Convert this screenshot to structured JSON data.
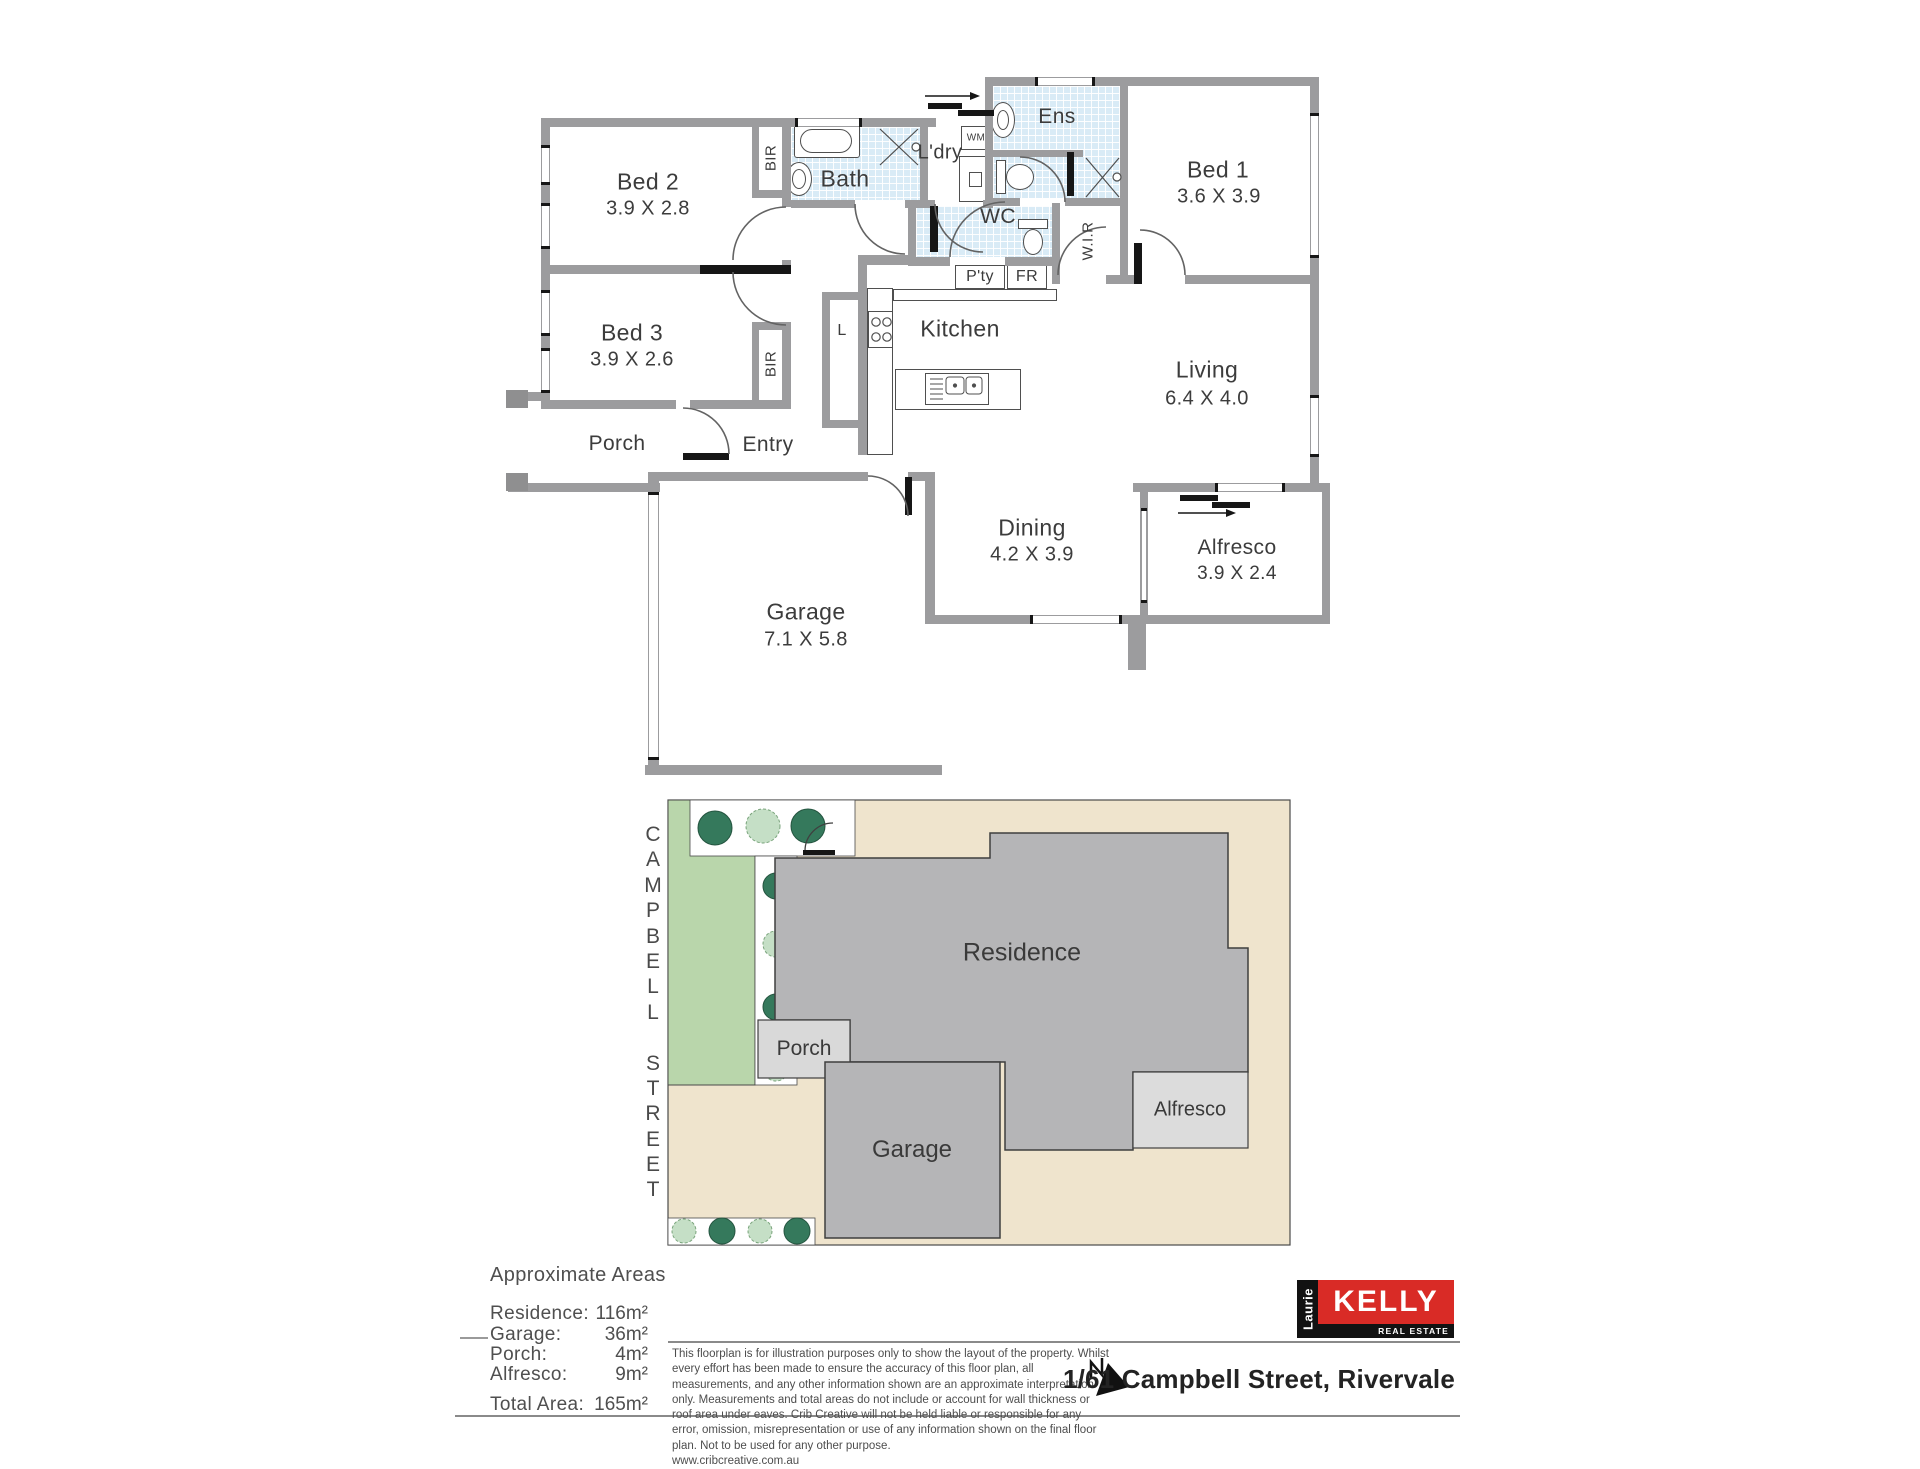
{
  "floor_plan": {
    "rooms": {
      "bed1": {
        "name": "Bed 1",
        "dims": "3.6 X 3.9"
      },
      "bed2": {
        "name": "Bed 2",
        "dims": "3.9 X 2.8"
      },
      "bed3": {
        "name": "Bed 3",
        "dims": "3.9 X 2.6"
      },
      "bath": {
        "name": "Bath"
      },
      "ldry": {
        "name": "L'dry"
      },
      "ens": {
        "name": "Ens"
      },
      "wc": {
        "name": "WC"
      },
      "wir": {
        "name": "W.I.R"
      },
      "kitchen": {
        "name": "Kitchen"
      },
      "living": {
        "name": "Living",
        "dims": "6.4 X 4.0"
      },
      "dining": {
        "name": "Dining",
        "dims": "4.2 X 3.9"
      },
      "alfresco": {
        "name": "Alfresco",
        "dims": "3.9 X 2.4"
      },
      "garage": {
        "name": "Garage",
        "dims": "7.1 X 5.8"
      },
      "porch": {
        "name": "Porch"
      },
      "entry": {
        "name": "Entry"
      }
    },
    "small": {
      "bir": "BIR",
      "wm": "WM",
      "pty": "P'ty",
      "fr": "FR",
      "l": "L"
    }
  },
  "site_plan": {
    "street": "CAMPBELL STREET",
    "blocks": {
      "residence": "Residence",
      "porch": "Porch",
      "garage": "Garage",
      "alfresco": "Alfresco"
    }
  },
  "areas": {
    "heading": "Approximate Areas",
    "rows": [
      {
        "label": "Residence:",
        "value": "116m²"
      },
      {
        "label": "Garage:",
        "value": "36m²"
      },
      {
        "label": "Porch:",
        "value": "4m²"
      },
      {
        "label": "Alfresco:",
        "value": "9m²"
      }
    ],
    "total": {
      "label": "Total Area:",
      "value": "165m²"
    }
  },
  "disclaimer": {
    "text": "This floorplan is for illustration purposes only to show the layout of the property. Whilst every effort has been made to ensure the accuracy of this floor plan, all measurements, and any other information shown are an approximate interpretation only. Measurements and total areas do not include or account for wall thickness or roof area under eaves. Crib Creative will not be held liable or responsible for any error, omission, misrepresentation or use of any information shown on the final floor plan. Not to be used for any other purpose.\nwww.cribcreative.com.au"
  },
  "footer": {
    "logo": {
      "vertical": "Laurie",
      "main": "KELLY",
      "sub": "REAL ESTATE"
    },
    "address": "1/61 Campbell Street, Rivervale"
  },
  "colors": {
    "wall_gray": "#9c9c9e",
    "tile_blue": "#d9ebf6",
    "lot_beige": "#efe4cd",
    "garden_green": "#b9d6ab",
    "tree_dark": "#35795c",
    "tree_light": "#c5dfc6",
    "residence_gray": "#b5b5b7",
    "light_block": "#d9d9d9",
    "brand_red": "#d92b26"
  }
}
